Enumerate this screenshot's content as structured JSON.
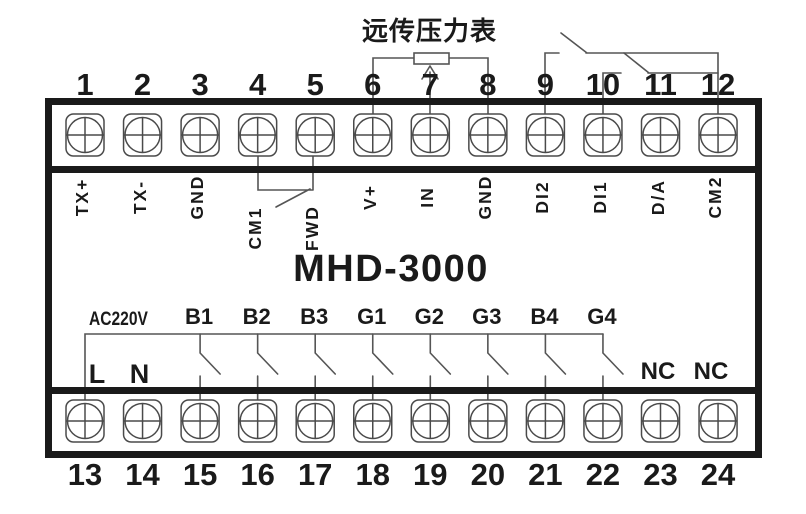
{
  "title": "MHD-3000",
  "annotations": {
    "pressure_gauge": "远传压力表",
    "power": "AC220V"
  },
  "top_terminals": [
    {
      "number": "1",
      "label": "TX+"
    },
    {
      "number": "2",
      "label": "TX-"
    },
    {
      "number": "3",
      "label": "GND"
    },
    {
      "number": "4",
      "label": "CM1"
    },
    {
      "number": "5",
      "label": "FWD"
    },
    {
      "number": "6",
      "label": "V+"
    },
    {
      "number": "7",
      "label": "IN"
    },
    {
      "number": "8",
      "label": "GND"
    },
    {
      "number": "9",
      "label": "DI2"
    },
    {
      "number": "10",
      "label": "DI1"
    },
    {
      "number": "11",
      "label": "D/A"
    },
    {
      "number": "12",
      "label": "CM2"
    }
  ],
  "bottom_terminals": [
    {
      "number": "13",
      "label": "L"
    },
    {
      "number": "14",
      "label": "N"
    },
    {
      "number": "15",
      "label": "B1"
    },
    {
      "number": "16",
      "label": "B2"
    },
    {
      "number": "17",
      "label": "B3"
    },
    {
      "number": "18",
      "label": "G1"
    },
    {
      "number": "19",
      "label": "G2"
    },
    {
      "number": "20",
      "label": "G3"
    },
    {
      "number": "21",
      "label": "B4"
    },
    {
      "number": "22",
      "label": "G4"
    },
    {
      "number": "23",
      "label": "NC"
    },
    {
      "number": "24",
      "label": "NC"
    }
  ],
  "colors": {
    "background": "#ffffff",
    "heavy_line": "#1a1a1a",
    "wire_line": "#555555",
    "screw_line": "#4a4a4a",
    "text": "#1a1a1a"
  }
}
